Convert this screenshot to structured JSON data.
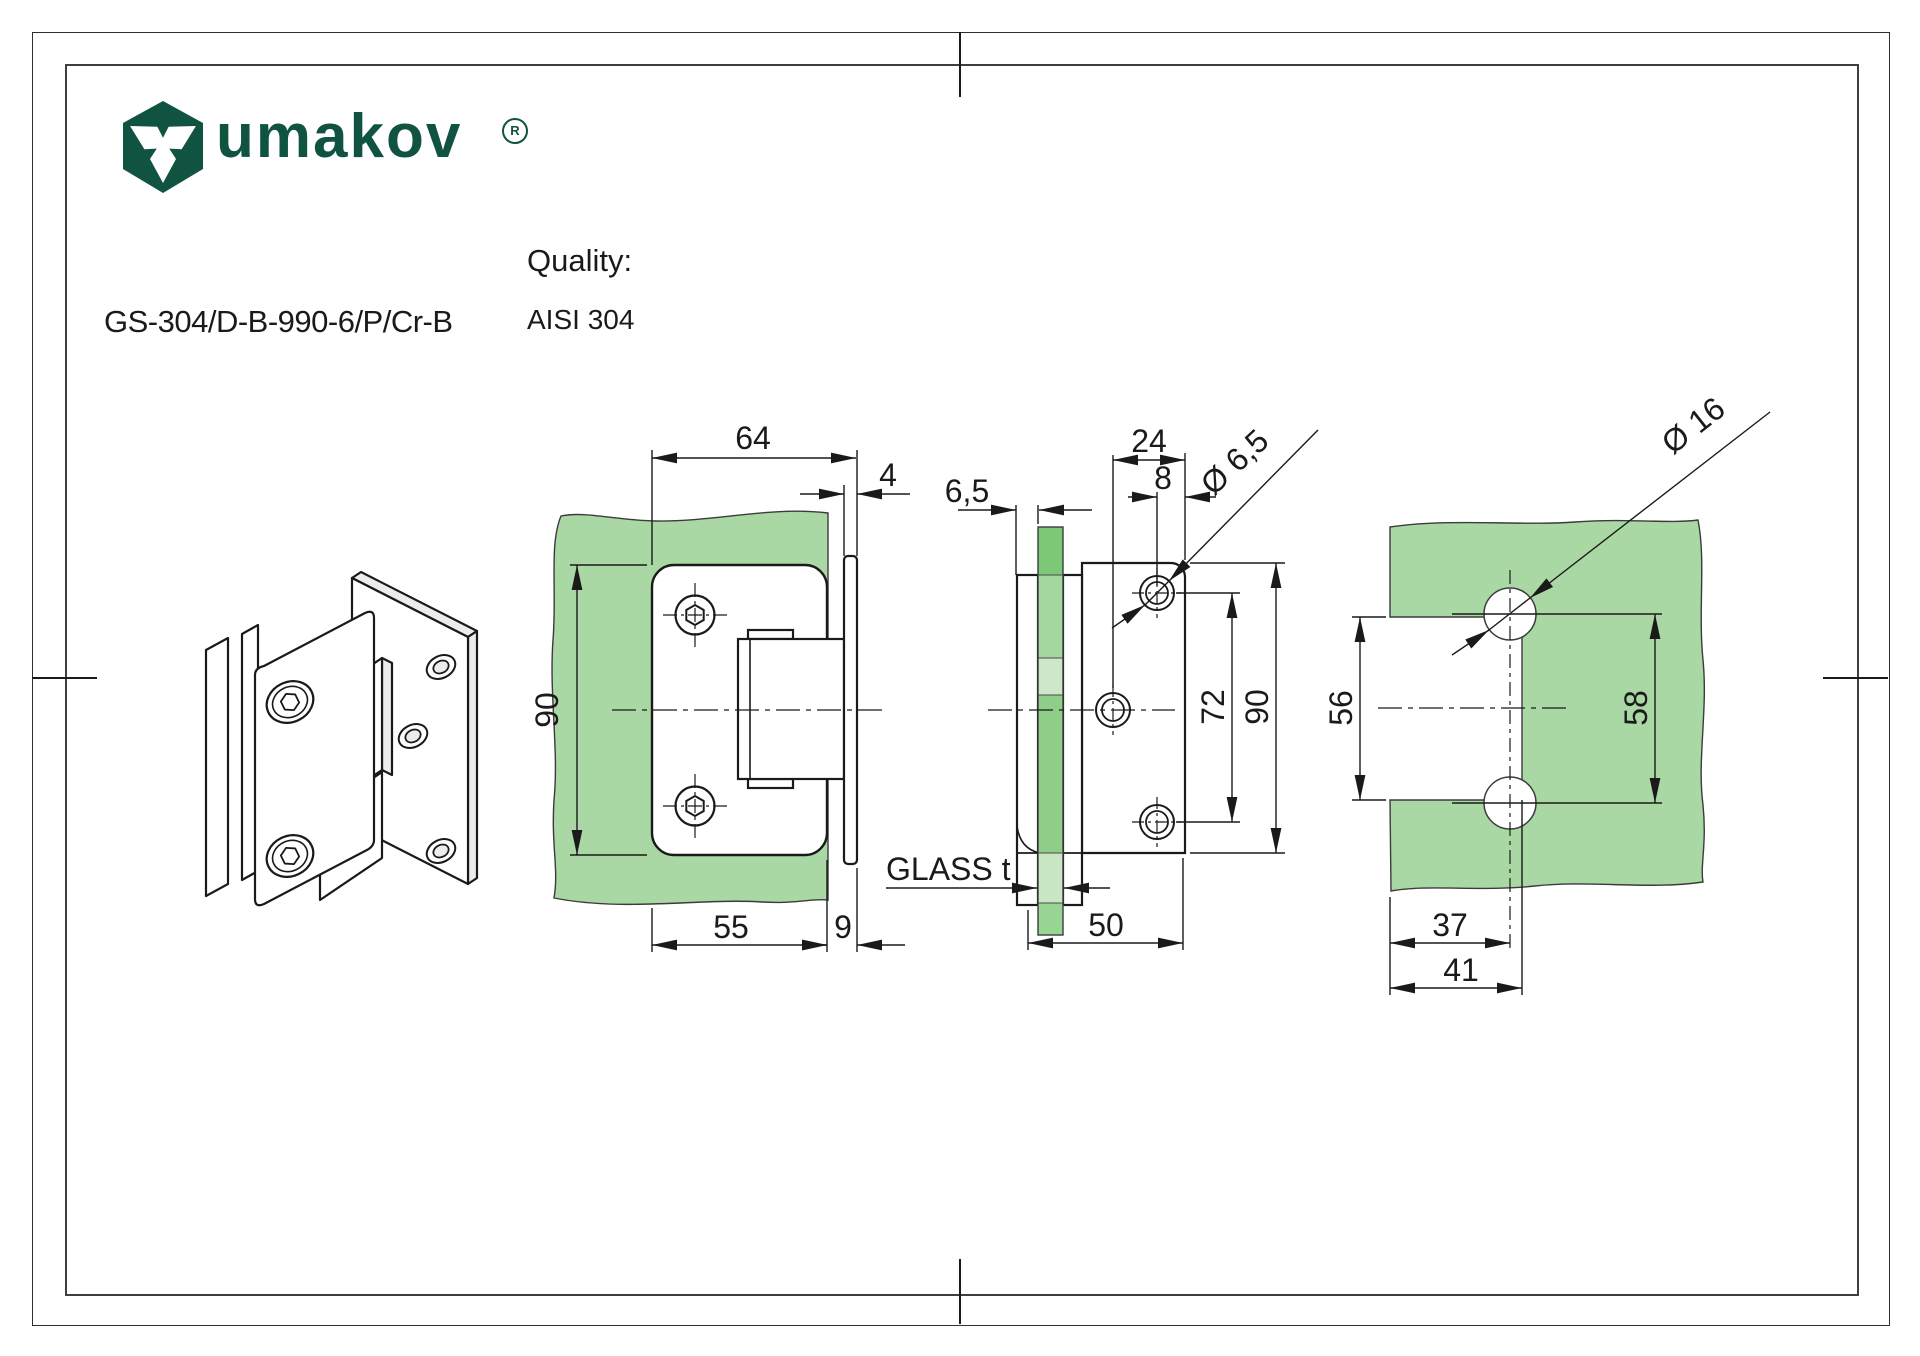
{
  "header": {
    "logo_text": "umakov",
    "registered": "R",
    "part_number": "GS-304/D-B-990-6/P/Cr-B",
    "quality_label": "Quality:",
    "quality_value": "AISI 304"
  },
  "colors": {
    "brand_green": "#0f5340",
    "glass_green": "#a9d8a4",
    "line_color": "#1a1a1a"
  },
  "dims": {
    "front": {
      "total_width": "64",
      "wall_plate_thickness": "4",
      "height": "90",
      "plate_width": "55",
      "offset": "9"
    },
    "side": {
      "glass_offset": "6,5",
      "hole_center_offset": "24",
      "hole_edge_offset": "8",
      "screw_hole_dia": "Ø 6,5",
      "hole_spacing": "72",
      "height": "90",
      "width": "50",
      "glass_thickness_label": "GLASS t"
    },
    "cutout": {
      "hole_dia": "Ø 16",
      "notch_height": "56",
      "hole_spacing": "58",
      "hole_center_depth": "37",
      "notch_depth": "41"
    }
  }
}
